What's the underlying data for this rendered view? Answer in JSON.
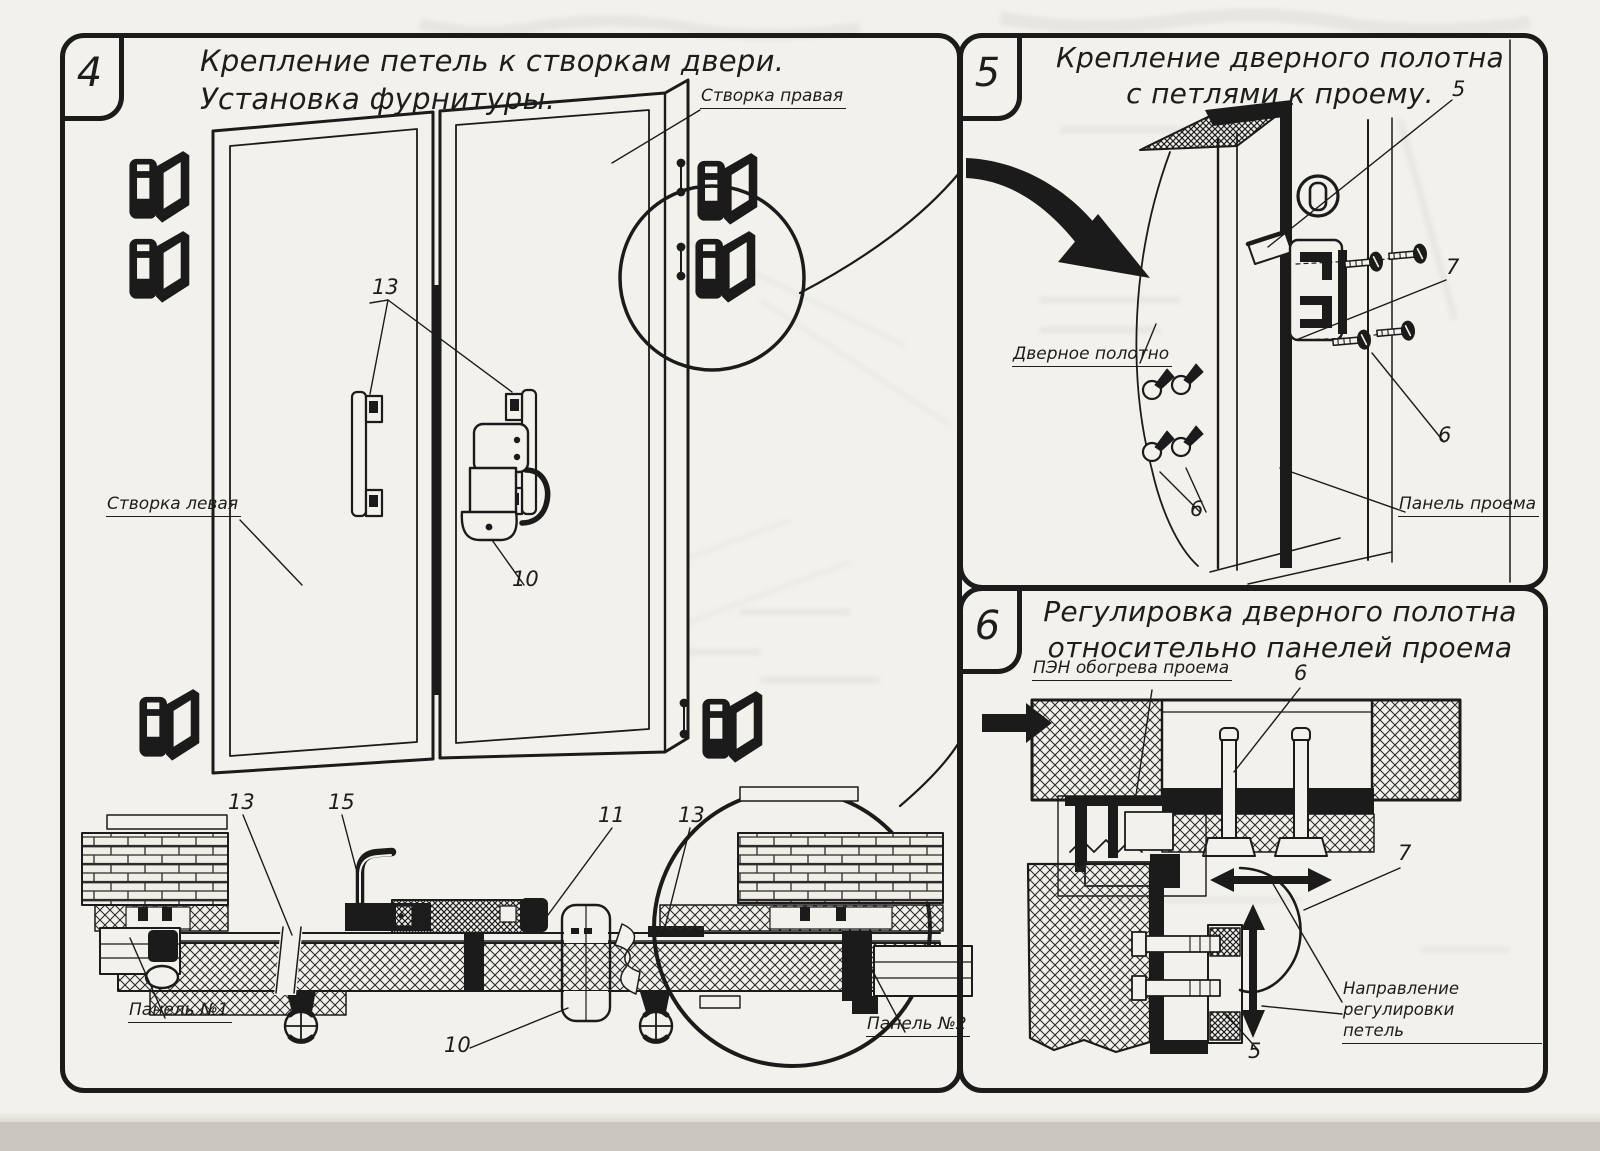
{
  "page": {
    "paper_color": "#f3f1ec",
    "ink_color": "#1b1b1b",
    "scanner_strip_color": "#cac7c0"
  },
  "panel4": {
    "number": "4",
    "title": [
      "Крепление петель к створкам двери.",
      "Установка фурнитуры."
    ],
    "labels": {
      "right_leaf": "Створка правая",
      "left_leaf": "Створка левая",
      "panel_1": "Панель №1",
      "panel_2": "Панель №2"
    },
    "callouts": {
      "handles": "13",
      "latch": "10",
      "section_left_13": "13",
      "section_handle_15": "15",
      "section_lock_11": "11",
      "section_right_13": "13",
      "section_latch_10": "10"
    }
  },
  "panel5": {
    "number": "5",
    "title": [
      "Крепление дверного полотна",
      "с петлями к проему."
    ],
    "labels": {
      "door_leaf": "Дверное полотно",
      "opening_panel": "Панель проема"
    },
    "callouts": {
      "hinge_5": "5",
      "bracket_7": "7",
      "screws_right_6": "6",
      "screws_left_6": "6"
    }
  },
  "panel6": {
    "number": "6",
    "title": [
      "Регулировка дверного полотна",
      "относительно панелей проема"
    ],
    "labels": {
      "heater": "ПЭН обогрева проема",
      "adjust_direction": [
        "Направление регулировки",
        "петель"
      ]
    },
    "callouts": {
      "bolt_6": "6",
      "hinge_arm_7": "7",
      "hinge_bottom_5": "5"
    }
  }
}
